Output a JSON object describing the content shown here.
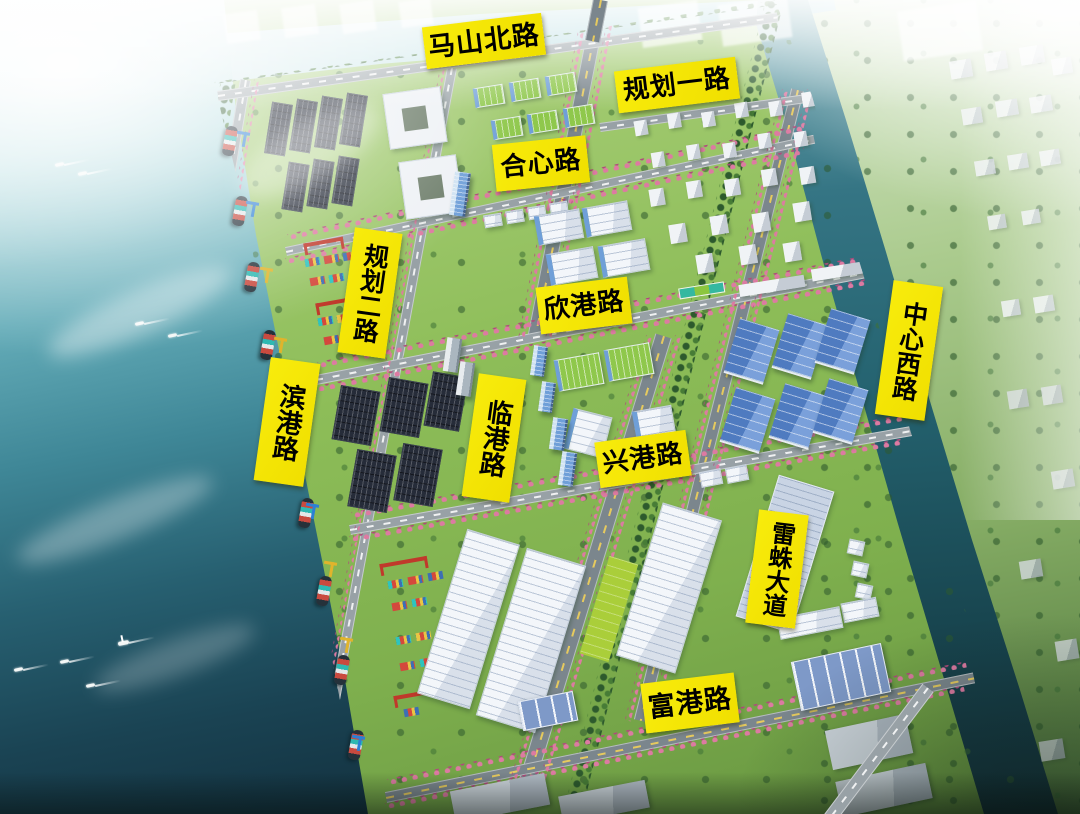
{
  "map": {
    "road_labels": {
      "mashan_north_road": {
        "text": "马山北路",
        "orientation": "horizontal"
      },
      "guihua_road_1": {
        "text": "规划一路",
        "orientation": "horizontal"
      },
      "hexin_road": {
        "text": "合心路",
        "orientation": "horizontal"
      },
      "xingang_road": {
        "text": "欣港路",
        "orientation": "horizontal"
      },
      "guihua_road_2": {
        "text": "规划二路",
        "orientation": "vertical"
      },
      "bingang_road": {
        "text": "滨港路",
        "orientation": "vertical"
      },
      "lingang_road": {
        "text": "临港路",
        "orientation": "vertical"
      },
      "zhongxin_west_road": {
        "text": "中心西路",
        "orientation": "vertical"
      },
      "xinggang_road": {
        "text": "兴港路",
        "orientation": "horizontal"
      },
      "leizhu_avenue": {
        "text": "雷蛛大道",
        "orientation": "vertical"
      },
      "fugang_road": {
        "text": "富港路",
        "orientation": "horizontal"
      }
    },
    "style": {
      "label_background": "#F2E205",
      "label_text_color": "#000000",
      "sea_deep_color": "#122F3D",
      "park_green_color": "#8DBD58",
      "river_color": "#24626F",
      "blossom_tree_color": "#DD7AA2"
    }
  }
}
